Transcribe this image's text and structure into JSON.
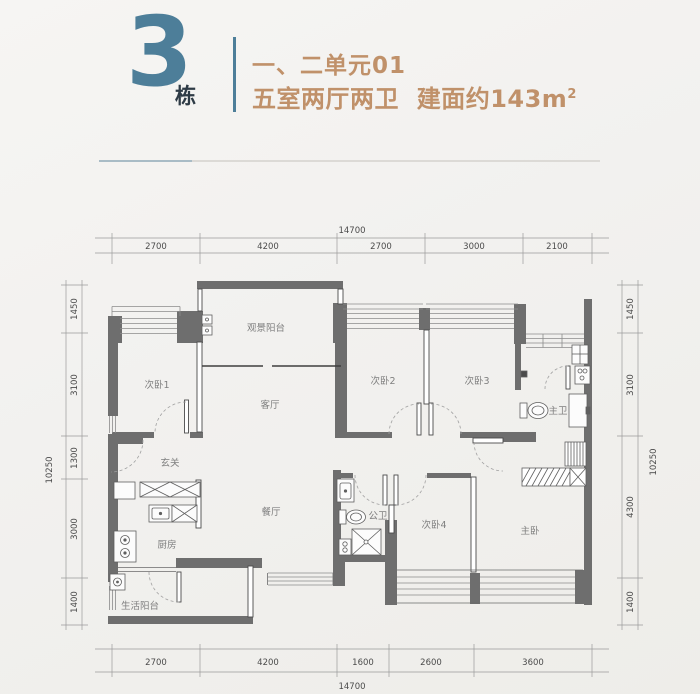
{
  "header": {
    "building_number": "3",
    "building_suffix": "栋",
    "unit_line": "一、二单元01",
    "spec_line": "五室两厅两卫  建面约143m",
    "spec_sup": "2"
  },
  "plan": {
    "rooms": {
      "bedroom1": "次卧1",
      "view_balcony": "观景阳台",
      "bedroom2": "次卧2",
      "bedroom3": "次卧3",
      "living": "客厅",
      "master_bath": "主卫",
      "foyer": "玄关",
      "dining": "餐厅",
      "guest_bath": "公卫",
      "bedroom4": "次卧4",
      "master_bedroom": "主卧",
      "kitchen": "厨房",
      "service_balcony": "生活阳台"
    }
  },
  "dimensions": {
    "top": {
      "total": "14700",
      "segments": [
        "2700",
        "4200",
        "2700",
        "3000",
        "2100"
      ]
    },
    "bottom": {
      "total": "14700",
      "segments": [
        "2700",
        "4200",
        "1600",
        "2600",
        "3600"
      ]
    },
    "left": {
      "total": "10250",
      "segments": [
        "1450",
        "3100",
        "1300",
        "3000",
        "1400"
      ]
    },
    "right": {
      "total": "10250",
      "segments": [
        "1450",
        "3100",
        "4300",
        "1400"
      ]
    }
  },
  "colors": {
    "accent_teal": "#4d7e99",
    "accent_tan": "#c0916a",
    "suffix_dark": "#2e3b46",
    "wall_gray": "#6e6e6e",
    "background": "#f2f1ef"
  }
}
